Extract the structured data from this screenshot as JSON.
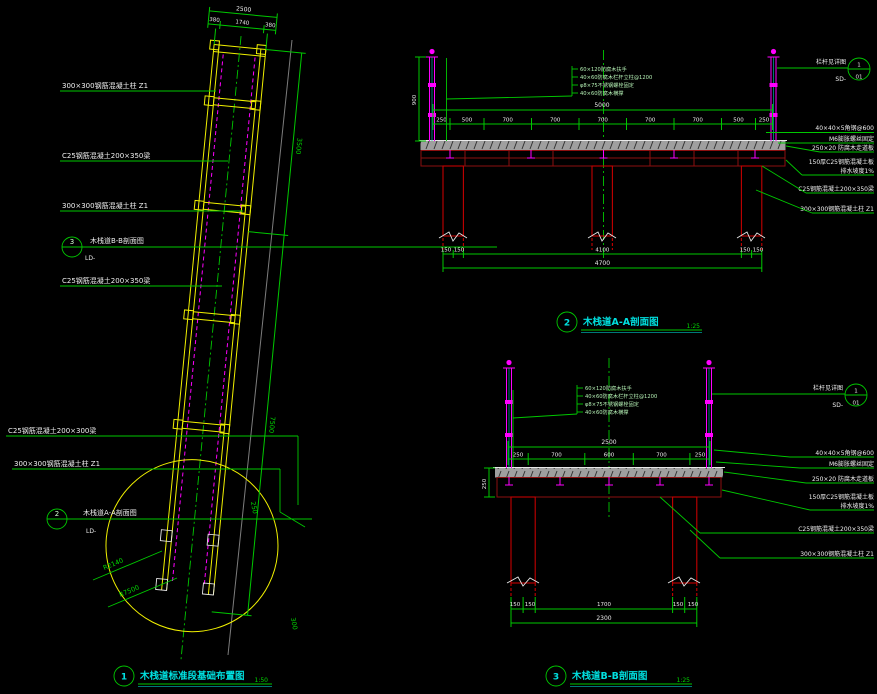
{
  "colors": {
    "background": "#000000",
    "dimension_green": "#00c800",
    "structure_yellow": "#f0f000",
    "railing_magenta": "#ff00ff",
    "title_cyan": "#00e0e0",
    "beam_dark_red": "#8d0f0f",
    "column_red": "#c40000",
    "deck_gray": "#9f9f9f",
    "text_white": "#f0f0f0"
  },
  "plan": {
    "labels": [
      "300×300钢筋混凝土柱 Z1",
      "C25钢筋混凝土200×350梁",
      "300×300钢筋混凝土柱 Z1",
      "C25钢筋混凝土200×350梁",
      "C25钢筋混凝土200×300梁",
      "300×300钢筋混凝土柱 Z1"
    ],
    "bubble_b": {
      "num": "3",
      "label": "木栈道B-B剖面图",
      "ref": "LD-"
    },
    "bubble_a": {
      "num": "2",
      "label": "木栈道A-A剖面图",
      "ref": "LD-"
    },
    "dims": {
      "total": "2500",
      "seg1": "380",
      "seg2": "1740",
      "seg3": "380",
      "len1": "3500",
      "len2": "7500",
      "r1": "R2140",
      "r2": "R7500",
      "d1": "250",
      "d2": "300"
    },
    "title": {
      "num": "1",
      "text": "木栈道标准段基础布置图",
      "scale": "1:50"
    }
  },
  "sectionA": {
    "title": {
      "num": "2",
      "text": "木栈道A-A剖面图",
      "scale": "1:25"
    },
    "detail": {
      "label": "栏杆见详图",
      "ref": "SD-",
      "top": "1",
      "bot": "01"
    },
    "notes": [
      "60×120防腐木扶手",
      "40×60防腐木栏杆立柱@1200",
      "φ8×75不锈钢螺栓固定",
      "40×60防腐木横撑"
    ],
    "labels": [
      "40×40×5角钢@600",
      "M6膨胀螺丝固定",
      "250×20 防腐木走道板",
      "150厚C25钢筋混凝土板",
      "排水坡度1%",
      "C25钢筋混凝土200×350梁",
      "300×300钢筋混凝土柱 Z1"
    ],
    "dim_top_total": "5000",
    "dim_top": [
      "250",
      "500",
      "700",
      "700",
      "700",
      "700",
      "700",
      "500",
      "250"
    ],
    "dim_bottom": [
      "150",
      "150",
      "4100",
      "150",
      "150"
    ],
    "dim_bottom_total": "4700",
    "dim_left": [
      "900"
    ]
  },
  "sectionB": {
    "title": {
      "num": "3",
      "text": "木栈道B-B剖面图",
      "scale": "1:25"
    },
    "detail": {
      "label": "栏杆见详图",
      "ref": "SD-",
      "top": "1",
      "bot": "01"
    },
    "notes": [
      "60×120防腐木扶手",
      "40×60防腐木栏杆立柱@1200",
      "φ8×75不锈钢螺栓固定",
      "40×60防腐木横撑"
    ],
    "labels": [
      "40×40×5角钢@600",
      "M6膨胀螺丝固定",
      "250×20 防腐木走道板",
      "150厚C25钢筋混凝土板",
      "排水坡度1%",
      "C25钢筋混凝土200×350梁",
      "300×300钢筋混凝土柱 Z1"
    ],
    "dim_top_total": "2500",
    "dim_top": [
      "250",
      "700",
      "600",
      "700",
      "250"
    ],
    "dim_bottom": [
      "150",
      "150",
      "1700",
      "150",
      "150"
    ],
    "dim_bottom_total": "2300",
    "dim_left": [
      "250"
    ]
  }
}
